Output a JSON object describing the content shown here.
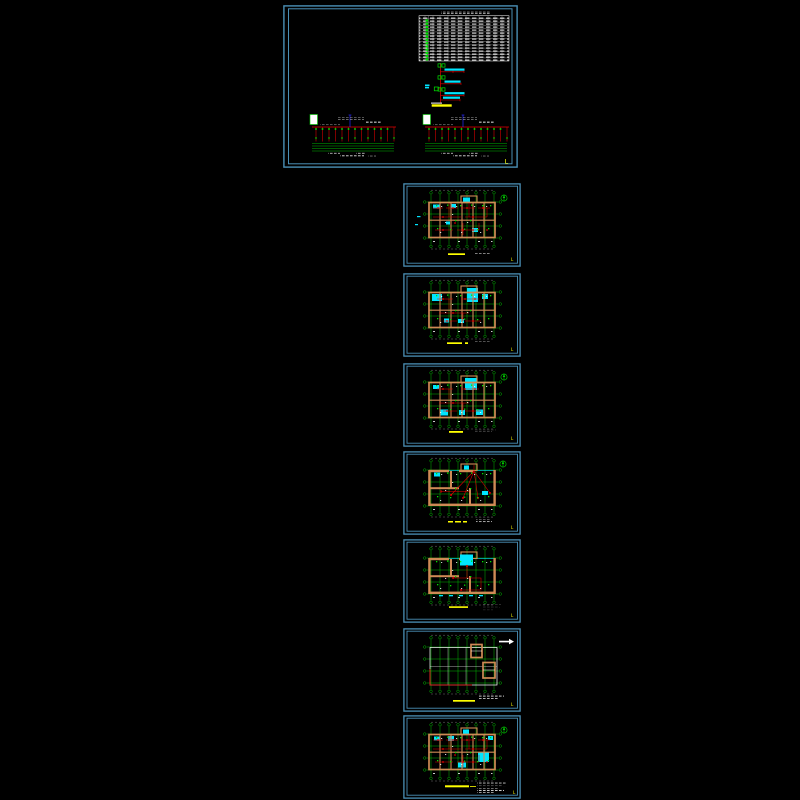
{
  "canvas": {
    "width": 800,
    "height": 800,
    "background": "#000000"
  },
  "palette": {
    "sheet_frame": "#4a8fb5",
    "axis_grid_green": "#00c800",
    "fixture_green": "#00e400",
    "wall_tan": "#cf8a55",
    "wiring_red": "#e80000",
    "highlight_cyan": "#00e5ff",
    "title_marker_yellow": "#ffff00",
    "text_white": "#ffffff",
    "accent_blue": "#2a2aff",
    "panel_fill_white": "#ffffff"
  },
  "document": {
    "type": "cad-drawing-set",
    "sheet_count": 8
  },
  "sheets": [
    {
      "id": "system-diagram",
      "kind": "distribution-system-diagram-and-schedule",
      "corner_mark": "L",
      "schedule_table": {
        "rows": 13,
        "columns": 11,
        "symbol_column": "green"
      },
      "riser": {
        "branches": 4,
        "label_color": "#00e5ff",
        "bus_bar_color": "#ffff00"
      },
      "bus_diagrams": {
        "count": 2,
        "feeder_drops_each": 13
      }
    },
    {
      "id": "floor-plan-a",
      "kind": "lighting-floor-plan",
      "corner_mark": "L",
      "north_arrow": true
    },
    {
      "id": "floor-plan-b",
      "kind": "lighting-floor-plan",
      "corner_mark": "L",
      "north_arrow": false
    },
    {
      "id": "floor-plan-c",
      "kind": "lighting-floor-plan",
      "corner_mark": "L",
      "north_arrow": true
    },
    {
      "id": "floor-plan-d",
      "kind": "power-floor-plan",
      "corner_mark": "L",
      "north_arrow": true
    },
    {
      "id": "floor-plan-e",
      "kind": "power-floor-plan",
      "corner_mark": "L",
      "north_arrow": false
    },
    {
      "id": "roof-plan",
      "kind": "roof-plan",
      "corner_mark": "L",
      "north_arrow": false
    },
    {
      "id": "floor-plan-f",
      "kind": "lighting-floor-plan",
      "corner_mark": "L",
      "north_arrow": true
    }
  ]
}
